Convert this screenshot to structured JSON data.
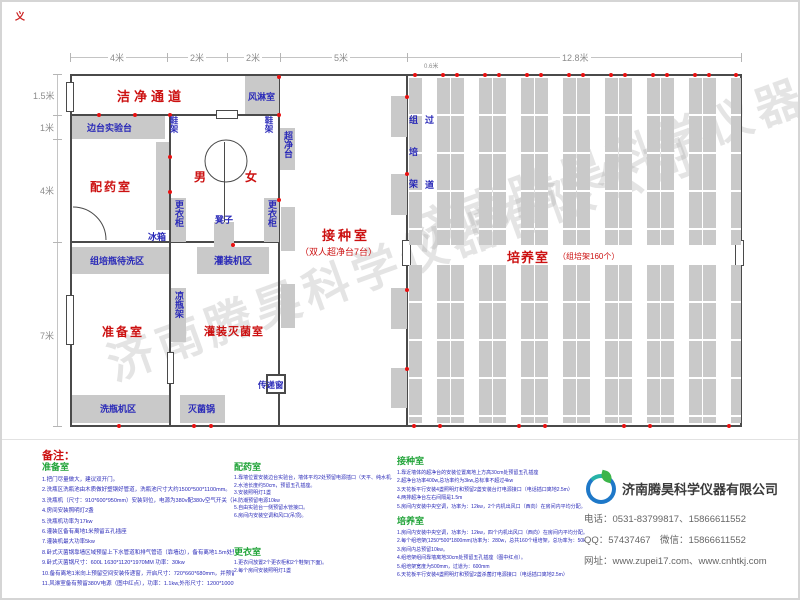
{
  "frame": {
    "corner_mark": "义"
  },
  "dimensions": {
    "top": [
      "4米",
      "2米",
      "2米",
      "5米",
      "12.8米"
    ],
    "left": [
      "1.5米",
      "1米",
      "4米",
      "7米"
    ],
    "aisle": "0.6米"
  },
  "rooms": {
    "clean_corridor": "洁净通道",
    "air_shower": "风淋室",
    "bench_lab": "边台实验台",
    "shoe_rack_left": "鞋架",
    "shoe_rack_right": "鞋架",
    "clean_bench": "超净台",
    "dispensing": "配药室",
    "male": "男",
    "female": "女",
    "locker_left": "更衣柜",
    "locker_right": "更衣柜",
    "stool": "凳子",
    "fridge": "冰箱",
    "wash_wait_area": "组培瓶待洗区",
    "filling_machine_area": "灌装机区",
    "inoculation": "接种室",
    "inoculation_sub": "（双人超净台7台）",
    "prep": "准备室",
    "cool_bottle_rack": "凉瓶架",
    "filling_sterilization": "灌装灭菌室",
    "washer_area": "洗瓶机区",
    "sterilizer": "灭菌锅",
    "pass_window": "传递窗",
    "culture": "培养室",
    "culture_sub": "（组培架160个）",
    "rack_col_label": "组培架",
    "aisle_col_label": "过道"
  },
  "watermark": "济南腾昊科学仪器有限公司",
  "notes": {
    "title": "备注：",
    "sections": [
      {
        "heading": "准备室",
        "items": [
          "1.把门尽量做大，建议双开门。",
          "2.洗瓶区洗瓶池由木质做好塑钢好管道，洗瓶池尺寸大约1500*500*1100mm。",
          "3.洗瓶机（尺寸：910*600*950mm）安装到位，电源为380v配380v空气开关（离地1.5米）。",
          "4.房间安装照明灯2盏",
          "5.洗瓶机功率为17kw",
          "6.灌装区备有离地1米预留五孔插座",
          "7.灌装机最大功率5kw",
          "8.卧式灭菌锅靠墙区域预留上下水管道和排气管道（靠墙边），备有离地1.5m处预留380v电源",
          "9.卧式灭菌锅尺寸：600L 1630*1120*1970MM 功率：30kw",
          "10.备有离地1米向上预留空间安装传递窗，开启尺寸：720*660*680mm，并预留220v五孔插座",
          "11.风淋室备有预留380V电源（图中红点），功率：1.1kw,外形尺寸：1200*1000*2100mm，"
        ]
      },
      {
        "heading": "配药室",
        "items": [
          "1.靠墙位置安装边台实验台，墙体平均2处预留电源插口（天平、纯水机、蒸馏器、磁力加热搅拌器等仪器使用）",
          "2.水池长度约50cm，预留五孔插座。",
          "3.安装照明灯1盏",
          "4.防潮预留电源10kw",
          "5.自由实验台一侧预留水管接口。",
          "6.房间内安装空调和风口(吊顶)。"
        ]
      },
      {
        "heading": "更衣室",
        "items": [
          "1.更衣间放置2个更衣柜和2个鞋架(下面)。",
          "2.每个房间安装照明灯1盏"
        ]
      },
      {
        "heading": "接种室",
        "items": [
          "1.靠近墙体的超净台的安装位置离地上方高30cm处预留五孔插座",
          "2.超净台功率400w,总功率约为3kw,总标准不超过4kw",
          "3.天花板平行安装4盏照明灯和预留2盏安装台灯电源接口（电话插口离地2.5m）",
          "4.两排超净台左右间隔是1.5m",
          "5.房间内安装中央空调，功率为：12kw，2个内机出风口（西向）在房间内平均分配。"
        ]
      },
      {
        "heading": "培养室",
        "items": [
          "1.房间内安装中央空调，功率为：12kw，四个内机出风口（西向）在房间内平均分配。",
          "2.每个组培架(1250*500*1800mm)功率为：280w，总共160个组培架，总功率为：50kw。",
          "3.房间内总预留10kw。",
          "4.组培架组间靠墙离地30cm处预留五孔插座（图中红点）。",
          "5.组培架宽度为500mm，过道为：600mm",
          "6.天花板平行安装4盏照明灯和预留2盏杀菌灯电源接口（电话插口离地2.5m）"
        ]
      }
    ]
  },
  "company": {
    "name": "济南腾昊科学仪器有限公司",
    "phone": "电话：0531-83799817、15866611552",
    "qq": "QQ：57437467　微信：15866611552",
    "web": "网址：www.zupei17.com、www.cnhtkj.com"
  },
  "colors": {
    "room_label": "#cc1111",
    "equipment_label": "#2a2ab8",
    "section_heading": "#1fa337",
    "wall": "#4a4a4a",
    "bench": "#c9c9c9",
    "outlet_dot": "#e81111"
  }
}
